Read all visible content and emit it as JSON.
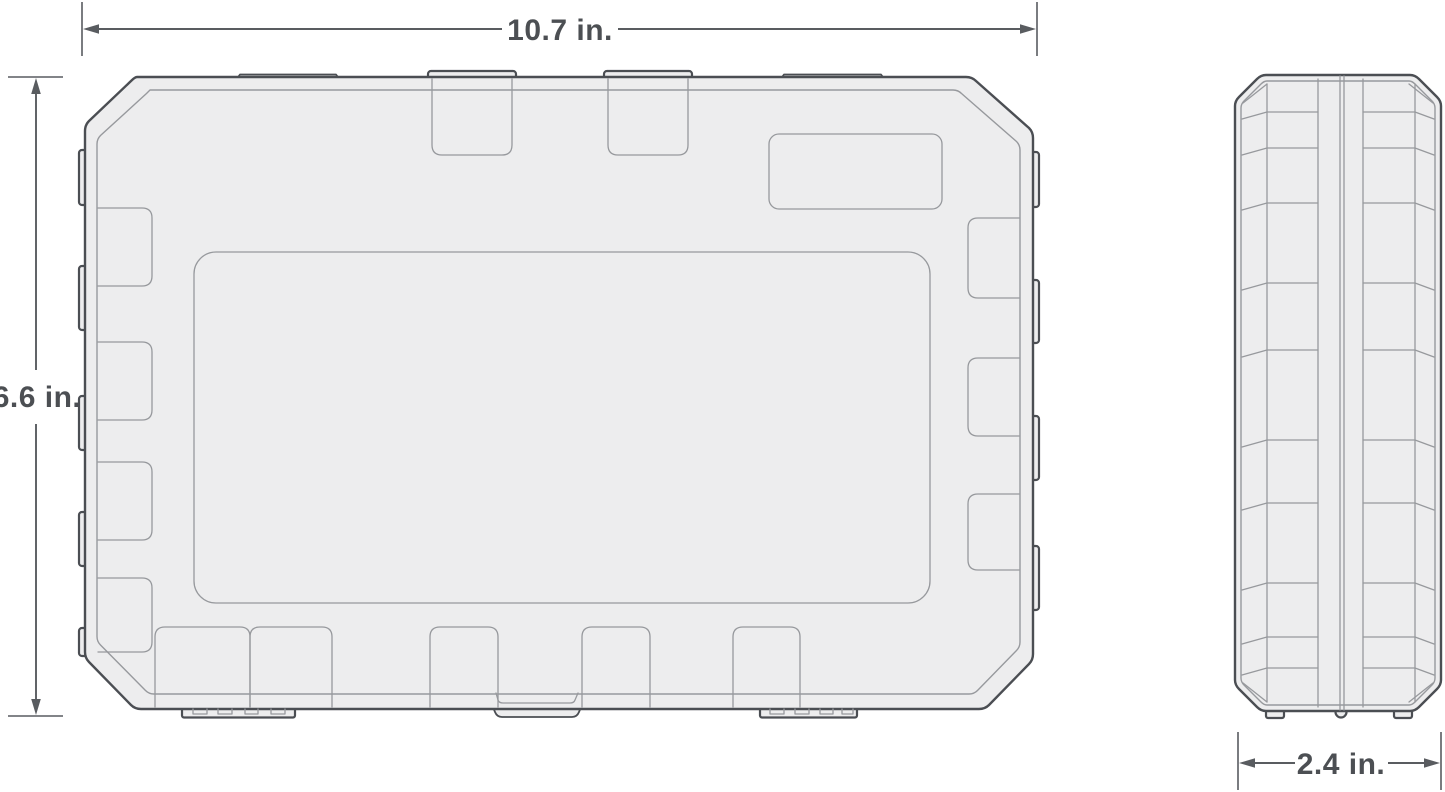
{
  "figure": {
    "title": "tool case dimension drawing",
    "views": [
      "front",
      "side"
    ],
    "dimensions": {
      "width_label": "10.7 in.",
      "height_label": "6.6 in.",
      "depth_label": "2.4 in."
    },
    "colors": {
      "background": "#ffffff",
      "fill": "#ededee",
      "outline": "#4b4e53",
      "line": "#97999d",
      "dim": "#595c60",
      "text": "#4c4f53"
    }
  }
}
